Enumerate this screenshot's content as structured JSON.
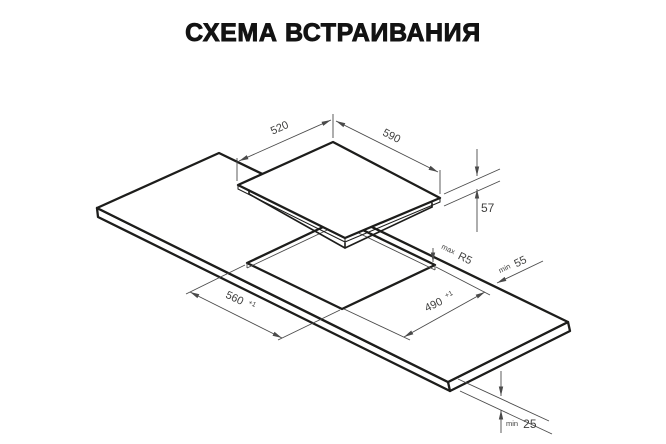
{
  "page": {
    "title": "СХЕМА ВСТРАИВАНИЯ"
  },
  "dimensions": {
    "cooktop_width": "520",
    "cooktop_depth": "590",
    "cooktop_height": "57",
    "cutout_length": "560",
    "cutout_length_tolerance": "+1",
    "cutout_width": "490",
    "cutout_width_tolerance": "+1",
    "corner_radius_prefix": "max",
    "corner_radius": "R5",
    "rear_clearance_prefix": "min",
    "rear_clearance": "55",
    "worktop_thickness_prefix": "min",
    "worktop_thickness": "25"
  },
  "colors": {
    "outline": "#1d1d1b",
    "dimension": "#4a4a4a",
    "background": "#ffffff",
    "title_text": "#131313"
  }
}
